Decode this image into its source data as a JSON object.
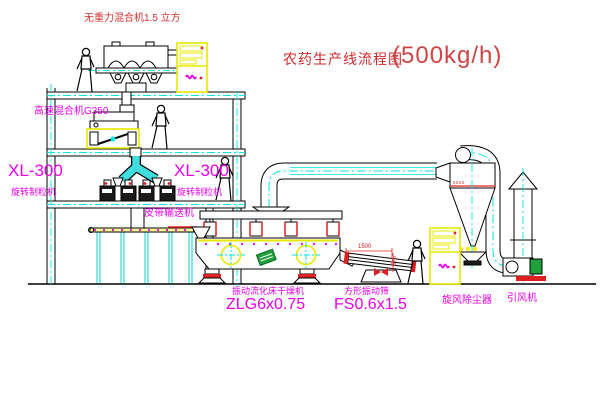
{
  "title": {
    "text": "农药生产线流程图",
    "capacity": "(500kg/h)"
  },
  "labels": {
    "gravity_mixer": "无重力混合机1.5 立方",
    "high_speed_mixer": "高速混合机G350",
    "granulator_left_model": "XL-300",
    "granulator_left_name": "旋转制粒机",
    "granulator_right_model": "XL-300",
    "granulator_right_name": "旋转制粒机",
    "belt_conveyor": "皮带输送机",
    "dryer_name": "振动流化床干燥机",
    "dryer_model": "ZLG6x0.75",
    "sieve_name": "方形振动筛",
    "sieve_model": "FS0.6x1.5",
    "cyclone": "旋风除尘器",
    "fan": "引风机"
  },
  "dimensions": {
    "sieve_width": "1500",
    "sieve_height": "545"
  },
  "colors": {
    "line": "#000000",
    "centerline": "#00e5e5",
    "label_magenta": "#e800e8",
    "label_red": "#d43030",
    "highlight_yellow": "#e8e800",
    "accent_red": "#e02020",
    "motor_green": "#1fa03c"
  }
}
